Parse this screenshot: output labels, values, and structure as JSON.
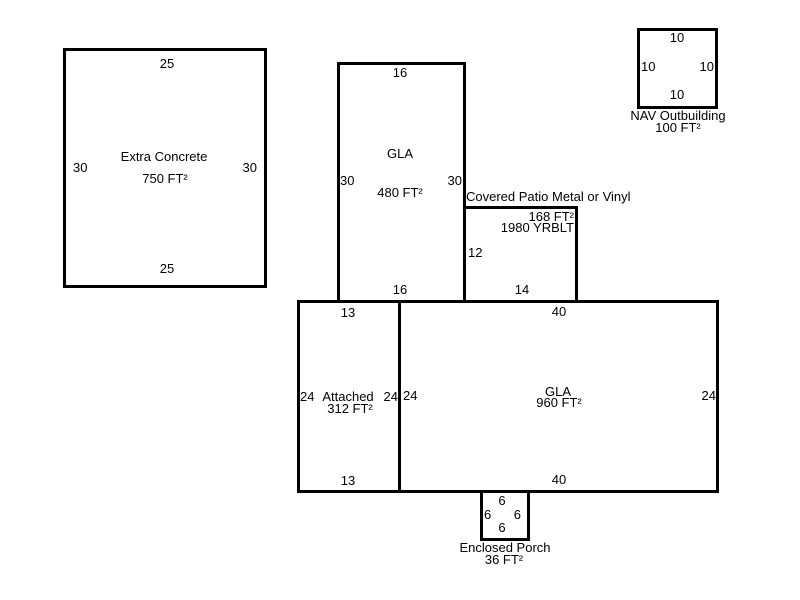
{
  "structures": {
    "extra_concrete": {
      "name": "Extra Concrete",
      "area": "750 FT²",
      "dim_top": "25",
      "dim_left": "30",
      "dim_right": "30",
      "dim_bottom": "25"
    },
    "gla_upper": {
      "name": "GLA",
      "area": "480 FT²",
      "dim_top": "16",
      "dim_left": "30",
      "dim_right": "30",
      "dim_bottom": "16"
    },
    "nav_outbuilding": {
      "name": "NAV Outbuilding",
      "area": "100 FT²",
      "dim_top": "10",
      "dim_left": "10",
      "dim_right": "10",
      "dim_bottom": "10"
    },
    "covered_patio": {
      "name": "Covered Patio Metal or Vinyl",
      "area": "168 FT²",
      "year_built": "1980 YRBLT",
      "dim_left": "12",
      "dim_bottom": "14"
    },
    "attached": {
      "name": "Attached",
      "area": "312 FT²",
      "dim_top": "13",
      "dim_left": "24",
      "dim_right": "24",
      "dim_bottom": "13"
    },
    "gla_main": {
      "name": "GLA",
      "area": "960 FT²",
      "dim_top": "40",
      "dim_left": "24",
      "dim_right": "24",
      "dim_bottom": "40"
    },
    "enclosed_porch": {
      "name": "Enclosed Porch",
      "area": "36 FT²",
      "dim_top": "6",
      "dim_left": "6",
      "dim_right": "6",
      "dim_bottom": "6"
    }
  },
  "colors": {
    "line": "#000000",
    "background": "#ffffff"
  }
}
